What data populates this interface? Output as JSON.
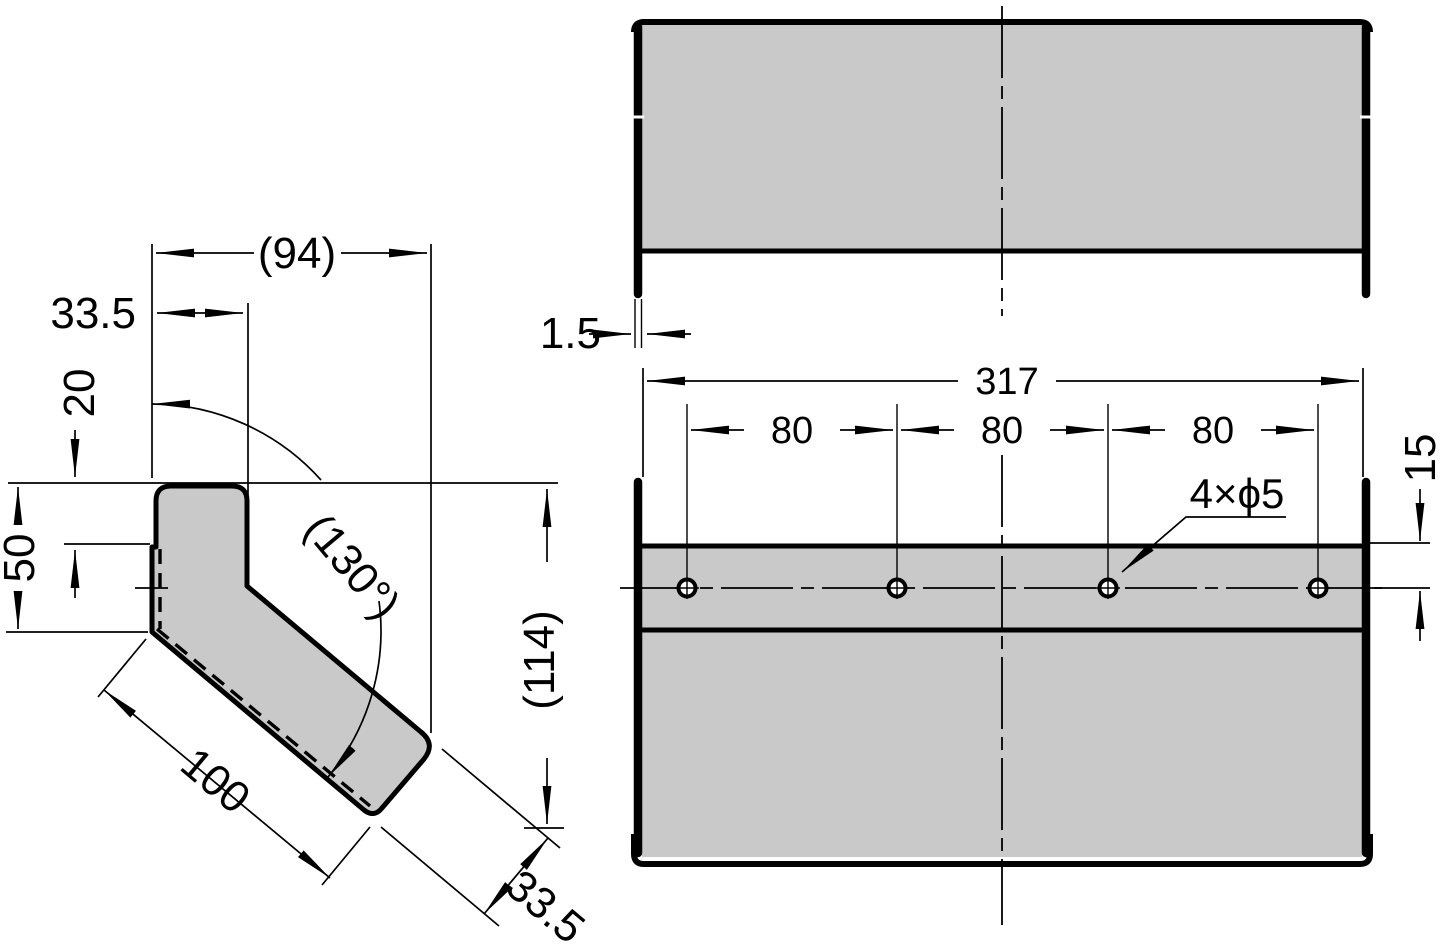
{
  "drawing": {
    "type": "orthographic-projection-technical-drawing",
    "units": "mm",
    "colors": {
      "part_fill": "#c9c9c9",
      "line_color": "#000000",
      "background": "#ffffff"
    },
    "side_view": {
      "dims": {
        "overall_depth": "(94)",
        "flange_width_top": "33.5",
        "hook_drop": "20",
        "back_height": "50",
        "bend_angle": "(130°)",
        "arm_length": "100",
        "arm_width": "33.5",
        "overall_height": "(114)"
      }
    },
    "top_view": {
      "dims": {
        "material_thickness": "1.5"
      }
    },
    "front_view": {
      "hole_count": 4,
      "dims": {
        "overall_width": "317",
        "hole_pitch": [
          "80",
          "80",
          "80"
        ],
        "hole_spec": "4×ϕ5",
        "hole_offset_from_top": "15"
      }
    }
  }
}
